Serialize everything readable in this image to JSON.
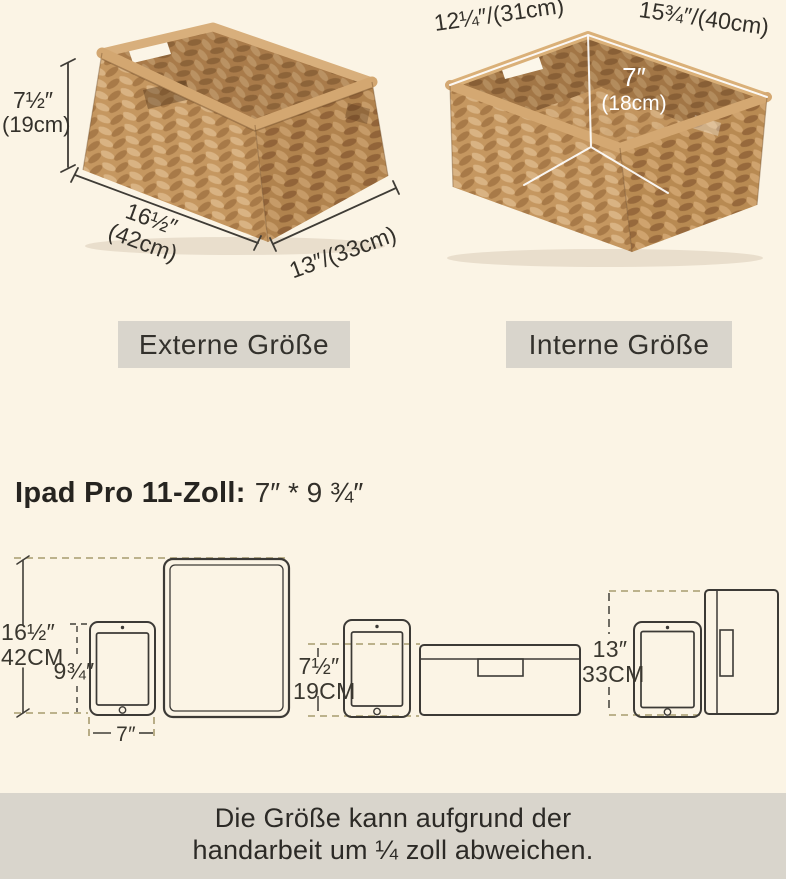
{
  "colors": {
    "background": "#fbf4e5",
    "panel_gray": "#d9d5cc",
    "text_dark": "#2e2c27",
    "dash_tan": "#a89b6e",
    "line_dark": "#413e38",
    "dimension_white": "#ffffff",
    "basket_light": "#d9b383",
    "basket_mid": "#c59760",
    "basket_dark": "#a87a48",
    "basket_rim": "#d6ab75"
  },
  "external_basket": {
    "label": "Externe Größe",
    "dims": {
      "height_in": "7½″",
      "height_cm": "(19cm)",
      "width_in": "16½″",
      "width_cm": "(42cm)",
      "depth": "13″/(33cm)"
    }
  },
  "internal_basket": {
    "label": "Interne Größe",
    "dims": {
      "width": "12¼″/(31cm)",
      "length": "15¾″/(40cm)",
      "height_in": "7″",
      "height_cm": "(18cm)"
    }
  },
  "ipad_section": {
    "heading_product": "Ipad Pro 11-Zoll:",
    "heading_size": "7″ * 9 ¾″",
    "dims": {
      "basket_width_in": "16½″",
      "basket_width_cm": "42CM",
      "ipad_height": "9¾″",
      "ipad_width": "7″",
      "basket_height_in": "7½″",
      "basket_height_cm": "19CM",
      "basket_depth_in": "13″",
      "basket_depth_cm": "33CM"
    }
  },
  "footer": {
    "line1": "Die Größe kann aufgrund der",
    "line2": "handarbeit um ¼ zoll abweichen."
  }
}
